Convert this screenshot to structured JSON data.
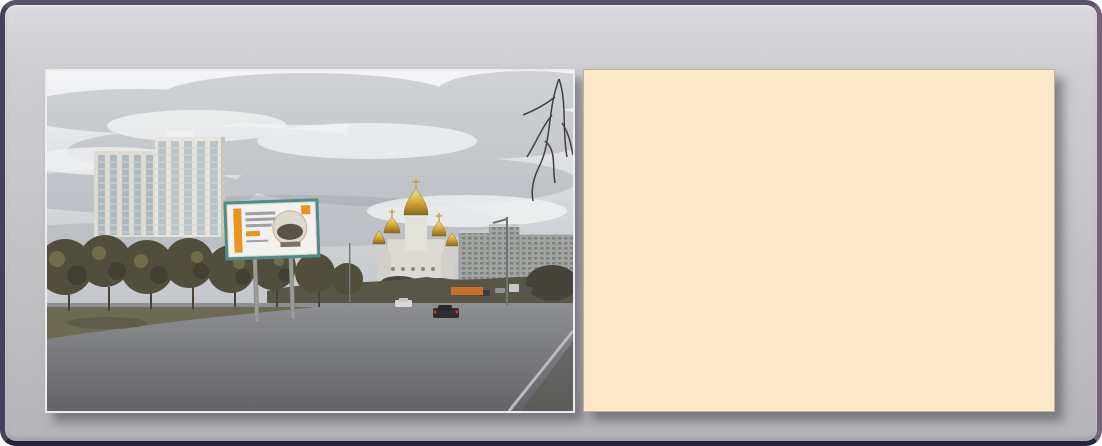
{
  "header": {
    "board_id": "VM-0695",
    "address": "ул. Героев Труда, 37",
    "side": "сторона Б (из центра)"
  },
  "colors": {
    "header_text": "#312d7c",
    "map_bg": "#fce8c6",
    "building_fill": "#f2a661",
    "building_stroke": "#cf8030",
    "building_number": "#9c2b0f",
    "highlight_fill": "#f59a3e",
    "highlight_stroke": "#cc2222",
    "road_fill": "#ffffff",
    "road_casing": "#b5b5b5",
    "minor_road": "#c9c9c9",
    "green_area": "#e2f2cf",
    "green_stroke": "#b9d69e",
    "gray_area": "#cccccc",
    "marker_red": "#a51212",
    "arrow_red": "#d42316",
    "direction_dot": "#2d2da0",
    "route_line": "#7b7b44",
    "label_color": "#3f3f3f"
  },
  "map": {
    "street_labels": [
      {
        "text": "Героев Труда ул.",
        "x": 52,
        "y": 126,
        "rot": 4
      },
      {
        "text": "Гвардейцев Широнинцев ул.",
        "x": 8,
        "y": 102,
        "rot": -55
      },
      {
        "text": "Тракторостроителей пр.",
        "x": 302,
        "y": 188,
        "rot": -52
      },
      {
        "text": "Героев Труда ул.",
        "x": 332,
        "y": 243,
        "rot": 40
      }
    ],
    "marker": {
      "x": 207,
      "y": 142,
      "w": 11,
      "h": 24,
      "rot": 14
    },
    "arrow": {
      "x": 178,
      "y": 133,
      "rot": 17
    },
    "direction_dots": [
      [
        1,
        132,
        5
      ],
      [
        135,
        133,
        8
      ],
      [
        177,
        142,
        14
      ],
      [
        270,
        179,
        -52
      ],
      [
        274,
        188,
        -52
      ],
      [
        260,
        225,
        -52
      ],
      [
        380,
        76,
        -52
      ],
      [
        457,
        331,
        42
      ]
    ],
    "green_areas": [
      {
        "type": "ellipse",
        "cx": 122,
        "cy": 37,
        "rx": 9,
        "ry": 16,
        "rot": -8
      },
      {
        "type": "ellipse",
        "cx": 224,
        "cy": 58,
        "rx": 8,
        "ry": 13,
        "rot": -8
      },
      {
        "type": "rect",
        "x": 260,
        "y": 51,
        "w": 40,
        "h": 34,
        "rot": 4
      },
      {
        "type": "ellipse",
        "cx": 457,
        "cy": 150,
        "rx": 12,
        "ry": 11,
        "rot": 0
      },
      {
        "type": "rect",
        "x": -12,
        "y": 284,
        "w": 72,
        "h": 70,
        "rot": 0,
        "r": 22
      },
      {
        "type": "rect",
        "x": 347,
        "y": 316,
        "w": 12,
        "h": 10,
        "rot": 40
      }
    ],
    "gray_areas": [
      {
        "x": 104,
        "y": 58,
        "w": 26,
        "h": 41,
        "rot": 0
      },
      {
        "x": 298,
        "y": 186,
        "w": 24,
        "h": 16,
        "rot": 38
      },
      {
        "x": -4,
        "y": 274,
        "w": 10,
        "h": 12,
        "rot": 0
      }
    ],
    "buildings": [
      [
        22,
        2,
        30,
        9,
        -54,
        ""
      ],
      [
        40,
        20,
        30,
        9,
        -54,
        "62"
      ],
      [
        6,
        36,
        24,
        9,
        -54,
        ""
      ],
      [
        26,
        54,
        26,
        9,
        -54,
        "58"
      ],
      [
        0,
        70,
        20,
        8,
        -54,
        ""
      ],
      [
        56,
        36,
        11,
        10,
        -54,
        ""
      ],
      [
        119,
        2,
        26,
        8,
        8,
        "37Б"
      ],
      [
        150,
        20,
        42,
        12,
        2,
        ""
      ],
      [
        140,
        32,
        12,
        30,
        2,
        "35Б"
      ],
      [
        237,
        2,
        28,
        8,
        4,
        "34Б"
      ],
      [
        282,
        2,
        10,
        22,
        -8,
        "36"
      ],
      [
        300,
        28,
        9,
        26,
        8,
        ""
      ],
      [
        200,
        58,
        38,
        10,
        8,
        "34"
      ],
      [
        214,
        42,
        9,
        22,
        8,
        ""
      ],
      [
        56,
        56,
        34,
        9,
        12,
        "50Б"
      ],
      [
        56,
        80,
        24,
        9,
        4,
        "26Б"
      ],
      [
        92,
        84,
        22,
        8,
        4,
        "26А"
      ],
      [
        120,
        68,
        9,
        30,
        4,
        "29"
      ],
      [
        148,
        66,
        9,
        30,
        4,
        "25"
      ],
      [
        103,
        102,
        15,
        10,
        4,
        "37",
        "hl"
      ],
      [
        127,
        104,
        48,
        9,
        5,
        "50"
      ],
      [
        166,
        80,
        9,
        28,
        4,
        "33Б"
      ],
      [
        190,
        88,
        26,
        8,
        4,
        "32А"
      ],
      [
        224,
        84,
        9,
        28,
        8,
        "33А"
      ],
      [
        250,
        80,
        9,
        28,
        8,
        "37А"
      ],
      [
        264,
        100,
        30,
        9,
        10,
        ""
      ],
      [
        300,
        98,
        9,
        28,
        20,
        ""
      ],
      [
        318,
        6,
        28,
        9,
        0,
        ""
      ],
      [
        344,
        26,
        30,
        9,
        38,
        ""
      ],
      [
        332,
        54,
        30,
        9,
        38,
        "105Б"
      ],
      [
        350,
        78,
        30,
        9,
        38,
        "105"
      ],
      [
        366,
        102,
        30,
        9,
        38,
        ""
      ],
      [
        384,
        126,
        28,
        9,
        38,
        "103"
      ],
      [
        399,
        148,
        11,
        10,
        38,
        ""
      ],
      [
        424,
        8,
        32,
        9,
        38,
        "107А"
      ],
      [
        440,
        32,
        32,
        9,
        38,
        "107Б"
      ],
      [
        412,
        50,
        24,
        8,
        -52,
        "107"
      ],
      [
        448,
        68,
        30,
        9,
        38,
        "162"
      ],
      [
        432,
        92,
        30,
        9,
        38,
        "162В"
      ],
      [
        452,
        116,
        28,
        9,
        38,
        "160Г"
      ],
      [
        434,
        128,
        22,
        8,
        -52,
        "160Б"
      ],
      [
        450,
        146,
        24,
        8,
        38,
        "160"
      ],
      [
        398,
        186,
        30,
        9,
        38,
        "159Б"
      ],
      [
        448,
        178,
        22,
        9,
        38,
        ""
      ],
      [
        378,
        197,
        16,
        12,
        38,
        "45"
      ],
      [
        340,
        214,
        9,
        26,
        38,
        "43"
      ],
      [
        406,
        219,
        30,
        9,
        38,
        "47Б"
      ],
      [
        412,
        240,
        30,
        9,
        38,
        "47А"
      ],
      [
        376,
        245,
        42,
        10,
        38,
        "47"
      ],
      [
        430,
        263,
        26,
        9,
        38,
        "47В"
      ],
      [
        436,
        294,
        26,
        9,
        38,
        "49"
      ],
      [
        306,
        263,
        44,
        10,
        40,
        "60"
      ],
      [
        268,
        283,
        38,
        10,
        40,
        "66"
      ],
      [
        294,
        303,
        34,
        9,
        40,
        "69А"
      ],
      [
        260,
        319,
        28,
        9,
        40,
        "59Б"
      ],
      [
        348,
        313,
        40,
        10,
        40,
        "70"
      ],
      [
        224,
        276,
        9,
        28,
        38,
        ""
      ],
      [
        238,
        302,
        9,
        28,
        38,
        ""
      ],
      [
        206,
        330,
        28,
        9,
        38,
        ""
      ],
      [
        20,
        170,
        40,
        9,
        14,
        ""
      ],
      [
        72,
        182,
        9,
        24,
        14,
        ""
      ],
      [
        4,
        216,
        30,
        9,
        14,
        "46Б"
      ],
      [
        0,
        238,
        22,
        9,
        14,
        "48"
      ],
      [
        44,
        212,
        28,
        9,
        14,
        "52А"
      ],
      [
        68,
        204,
        28,
        9,
        14,
        "54А"
      ],
      [
        100,
        186,
        32,
        9,
        14,
        "54"
      ],
      [
        106,
        224,
        9,
        28,
        14,
        "54В"
      ],
      [
        122,
        214,
        22,
        9,
        14,
        "56"
      ],
      [
        126,
        232,
        22,
        9,
        14,
        "52Б"
      ],
      [
        154,
        206,
        28,
        9,
        14,
        "58А"
      ],
      [
        182,
        196,
        26,
        9,
        14,
        "60"
      ],
      [
        180,
        232,
        24,
        9,
        14,
        "56А"
      ],
      [
        200,
        242,
        22,
        9,
        14,
        "58"
      ],
      [
        170,
        258,
        24,
        9,
        14,
        "55"
      ],
      [
        44,
        250,
        26,
        9,
        14,
        "57А"
      ],
      [
        52,
        266,
        10,
        8,
        14,
        ""
      ],
      [
        112,
        268,
        28,
        9,
        14,
        "144"
      ],
      [
        140,
        274,
        24,
        9,
        14,
        "146Б"
      ],
      [
        62,
        284,
        26,
        9,
        14,
        "147"
      ],
      [
        98,
        288,
        24,
        9,
        14,
        "142А"
      ],
      [
        140,
        298,
        22,
        9,
        14,
        "69"
      ],
      [
        26,
        322,
        26,
        9,
        14,
        "97Б"
      ],
      [
        78,
        322,
        26,
        9,
        14,
        "97В"
      ],
      [
        198,
        312,
        26,
        9,
        30,
        "142"
      ],
      [
        60,
        332,
        26,
        8,
        14,
        "57Б"
      ]
    ]
  }
}
